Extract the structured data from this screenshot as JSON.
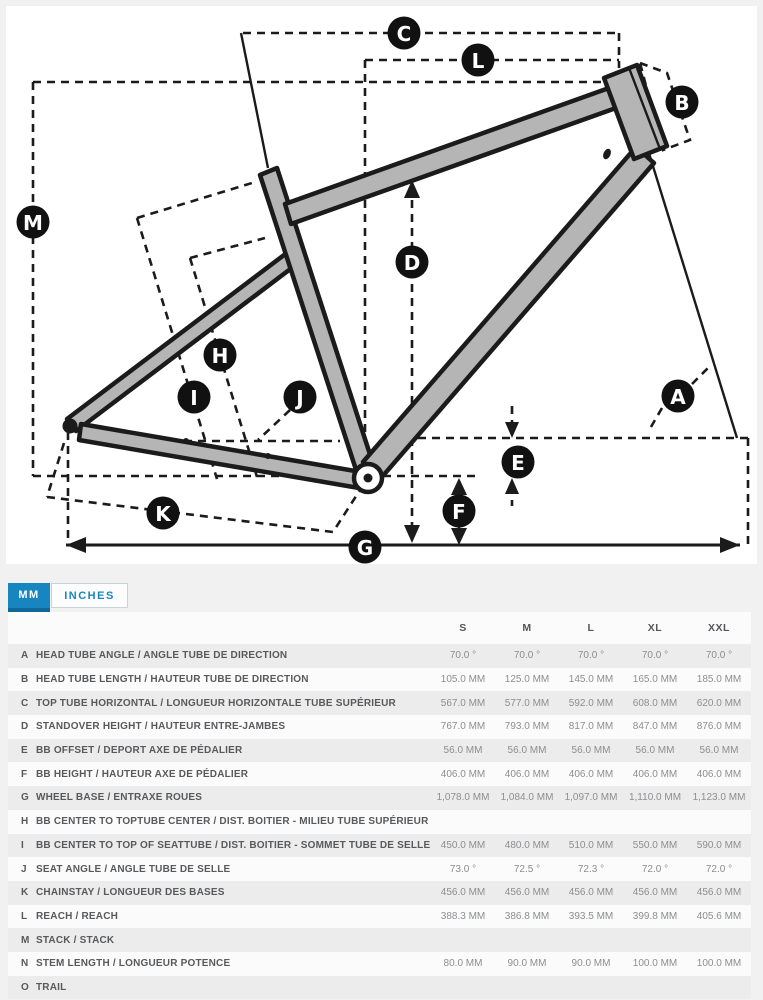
{
  "tabs": {
    "mm_label": "MM",
    "inches_label": "INCHES",
    "active": "MM"
  },
  "colors": {
    "accent_blue": "#1786c0",
    "badge_bg": "#111111",
    "badge_text": "#ffffff",
    "frame_fill": "#b5b5b5",
    "frame_stroke": "#1b1b1b",
    "row_alt_bg": "#ececec"
  },
  "diagram": {
    "badges": [
      {
        "letter": "C",
        "x": 404,
        "y": 33
      },
      {
        "letter": "L",
        "x": 478,
        "y": 60
      },
      {
        "letter": "B",
        "x": 682,
        "y": 102
      },
      {
        "letter": "M",
        "x": 33,
        "y": 222
      },
      {
        "letter": "D",
        "x": 412,
        "y": 262
      },
      {
        "letter": "H",
        "x": 220,
        "y": 355
      },
      {
        "letter": "I",
        "x": 194,
        "y": 397
      },
      {
        "letter": "J",
        "x": 300,
        "y": 397
      },
      {
        "letter": "A",
        "x": 678,
        "y": 396
      },
      {
        "letter": "E",
        "x": 518,
        "y": 462
      },
      {
        "letter": "F",
        "x": 459,
        "y": 511
      },
      {
        "letter": "K",
        "x": 163,
        "y": 513
      },
      {
        "letter": "G",
        "x": 365,
        "y": 547
      }
    ]
  },
  "table": {
    "size_headers": [
      "S",
      "M",
      "L",
      "XL",
      "XXL"
    ],
    "rows": [
      {
        "letter": "A",
        "label": "HEAD TUBE ANGLE / ANGLE TUBE DE DIRECTION",
        "values": [
          "70.0 °",
          "70.0 °",
          "70.0 °",
          "70.0 °",
          "70.0 °"
        ]
      },
      {
        "letter": "B",
        "label": "HEAD TUBE LENGTH / HAUTEUR TUBE DE DIRECTION",
        "values": [
          "105.0 MM",
          "125.0 MM",
          "145.0 MM",
          "165.0 MM",
          "185.0 MM"
        ]
      },
      {
        "letter": "C",
        "label": "TOP TUBE HORIZONTAL / LONGUEUR HORIZONTALE TUBE SUPÉRIEUR",
        "values": [
          "567.0 MM",
          "577.0 MM",
          "592.0 MM",
          "608.0 MM",
          "620.0 MM"
        ]
      },
      {
        "letter": "D",
        "label": "STANDOVER HEIGHT / HAUTEUR ENTRE-JAMBES",
        "values": [
          "767.0 MM",
          "793.0 MM",
          "817.0 MM",
          "847.0 MM",
          "876.0 MM"
        ]
      },
      {
        "letter": "E",
        "label": "BB OFFSET / DEPORT AXE DE PÉDALIER",
        "values": [
          "56.0 MM",
          "56.0 MM",
          "56.0 MM",
          "56.0 MM",
          "56.0 MM"
        ]
      },
      {
        "letter": "F",
        "label": "BB HEIGHT / HAUTEUR AXE DE PÉDALIER",
        "values": [
          "406.0 MM",
          "406.0 MM",
          "406.0 MM",
          "406.0 MM",
          "406.0 MM"
        ]
      },
      {
        "letter": "G",
        "label": "WHEEL BASE / ENTRAXE ROUES",
        "values": [
          "1,078.0 MM",
          "1,084.0 MM",
          "1,097.0 MM",
          "1,110.0 MM",
          "1,123.0 MM"
        ]
      },
      {
        "letter": "H",
        "label": "BB CENTER TO TOPTUBE CENTER / DIST. BOITIER - MILIEU TUBE SUPÉRIEUR",
        "values": [
          "",
          "",
          "",
          "",
          ""
        ]
      },
      {
        "letter": "I",
        "label": "BB CENTER TO TOP OF SEATTUBE / DIST. BOITIER - SOMMET TUBE DE SELLE",
        "values": [
          "450.0 MM",
          "480.0 MM",
          "510.0 MM",
          "550.0 MM",
          "590.0 MM"
        ]
      },
      {
        "letter": "J",
        "label": "SEAT ANGLE / ANGLE TUBE DE SELLE",
        "values": [
          "73.0 °",
          "72.5 °",
          "72.3 °",
          "72.0 °",
          "72.0 °"
        ]
      },
      {
        "letter": "K",
        "label": "CHAINSTAY / LONGUEUR DES BASES",
        "values": [
          "456.0 MM",
          "456.0 MM",
          "456.0 MM",
          "456.0 MM",
          "456.0 MM"
        ]
      },
      {
        "letter": "L",
        "label": "REACH / REACH",
        "values": [
          "388.3 MM",
          "386.8 MM",
          "393.5 MM",
          "399.8 MM",
          "405.6 MM"
        ]
      },
      {
        "letter": "M",
        "label": "STACK / STACK",
        "values": [
          "",
          "",
          "",
          "",
          ""
        ]
      },
      {
        "letter": "N",
        "label": "STEM LENGTH / LONGUEUR POTENCE",
        "values": [
          "80.0 MM",
          "90.0 MM",
          "90.0 MM",
          "100.0 MM",
          "100.0 MM"
        ]
      },
      {
        "letter": "O",
        "label": "TRAIL",
        "values": [
          "",
          "",
          "",
          "",
          ""
        ]
      }
    ]
  }
}
